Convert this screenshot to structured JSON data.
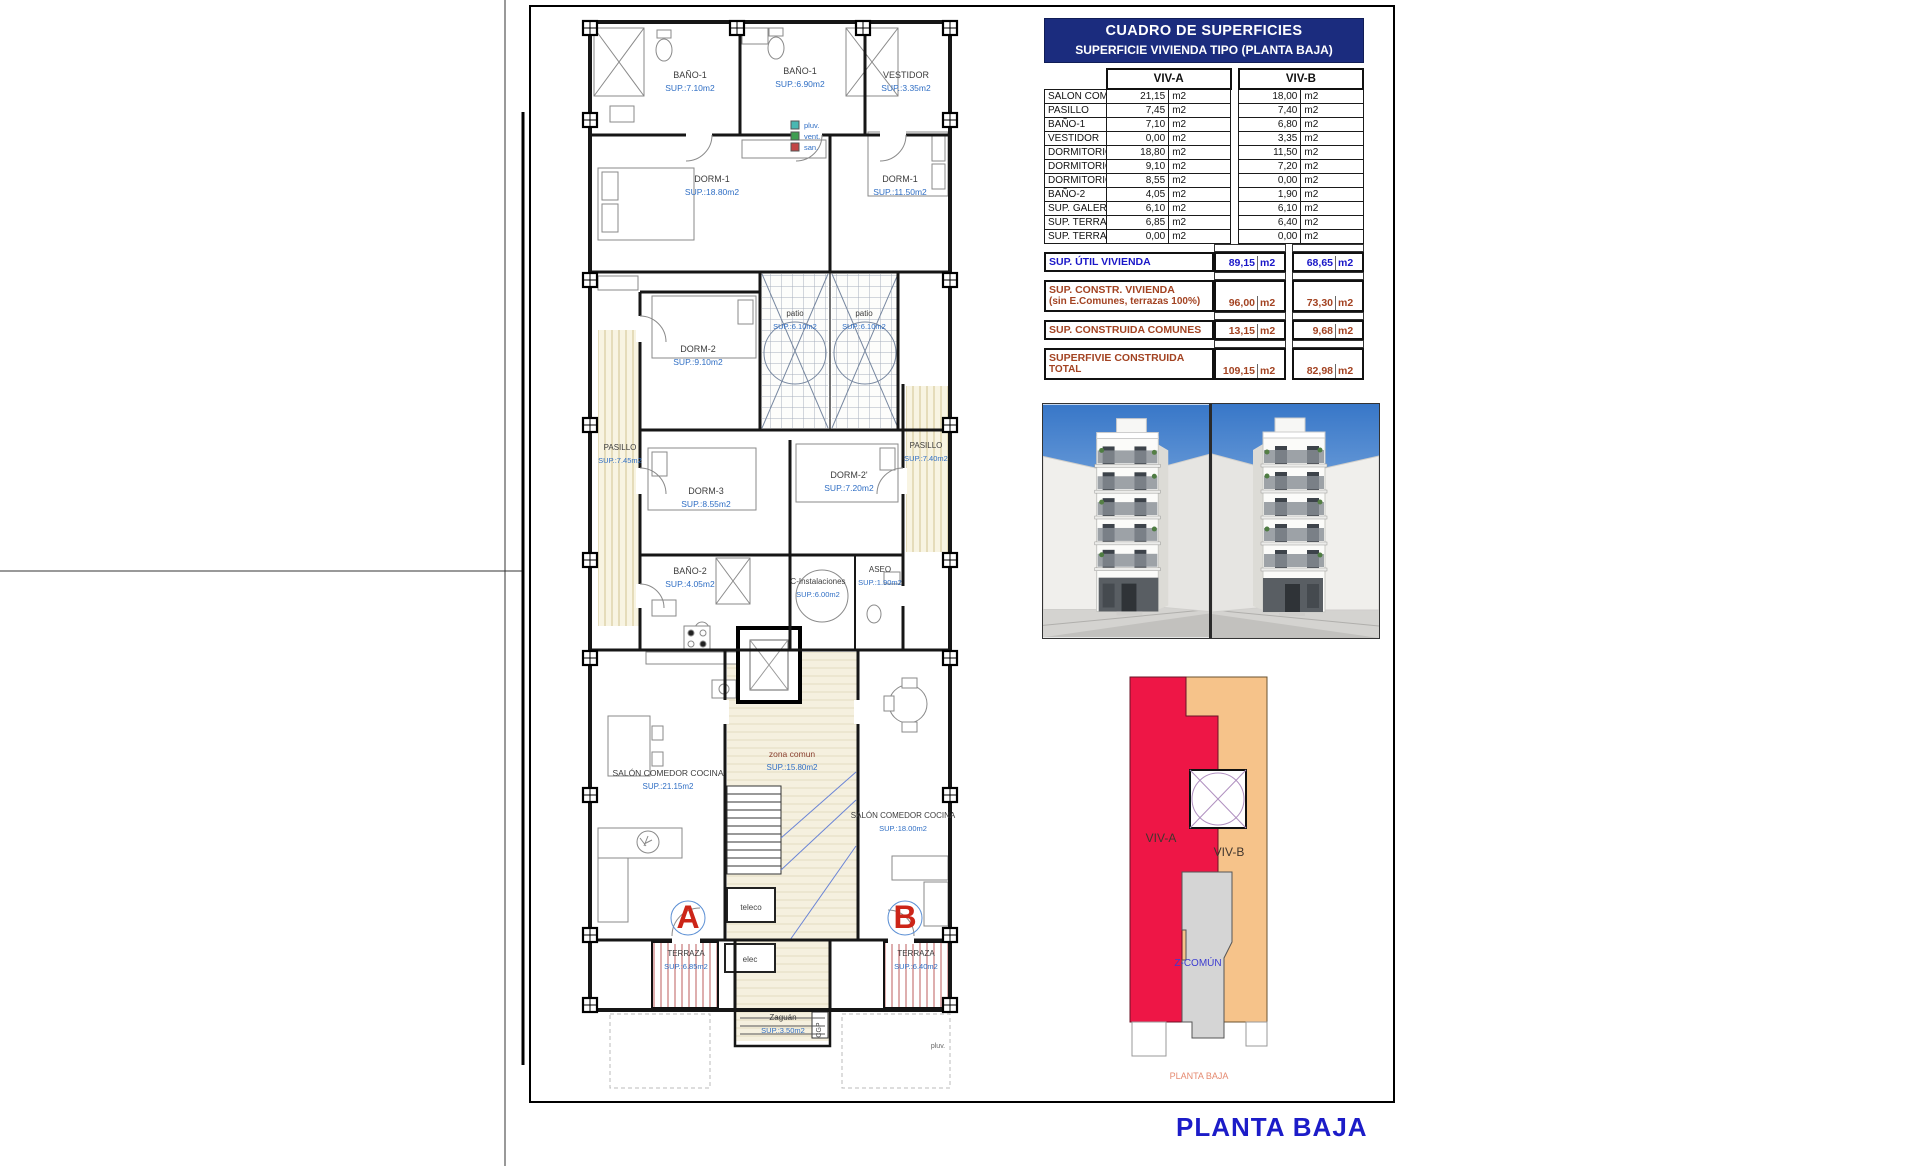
{
  "page": {
    "title": "PLANTA BAJA"
  },
  "table": {
    "title": "CUADRO DE SUPERFICIES",
    "subtitle": "SUPERFICIE VIVIENDA TIPO  (PLANTA BAJA)",
    "col_a": "VIV-A",
    "col_b": "VIV-B",
    "unit": "m2",
    "rows": [
      {
        "label": "SALON COMEDOR COCINA",
        "a": "21,15",
        "b": "18,00"
      },
      {
        "label": "PASILLO",
        "a": "7,45",
        "b": "7,40"
      },
      {
        "label": "BAÑO-1",
        "a": "7,10",
        "b": "6,80"
      },
      {
        "label": "VESTIDOR",
        "a": "0,00",
        "b": "3,35"
      },
      {
        "label": "DORMITORIO-1",
        "a": "18,80",
        "b": "11,50"
      },
      {
        "label": "DORMITORIO-2",
        "a": "9,10",
        "b": "7,20"
      },
      {
        "label": "DORMITORIO-3",
        "a": "8,55",
        "b": "0,00"
      },
      {
        "label": "BAÑO-2",
        "a": "4,05",
        "b": "1,90"
      },
      {
        "label": "SUP. GALERIA/PATIO",
        "a": "6,10",
        "b": "6,10"
      },
      {
        "label": "SUP. TERRAZA-1",
        "a": "6,85",
        "b": "6,40"
      },
      {
        "label": "SUP. TERRAZA-2",
        "a": "0,00",
        "b": "0,00"
      }
    ],
    "summary": [
      {
        "label": "SUP. ÚTIL VIVIENDA",
        "label2": "",
        "a": "89,15",
        "b": "68,65",
        "style": "blue"
      },
      {
        "label": "SUP. CONSTR. VIVIENDA",
        "label2": "(sin E.Comunes, terrazas 100%)",
        "a": "96,00",
        "b": "73,30",
        "style": "brown"
      },
      {
        "label": "SUP. CONSTRUIDA COMUNES",
        "label2": "",
        "a": "13,15",
        "b": "9,68",
        "style": "brown"
      },
      {
        "label": "SUPERFIVIE CONSTRUIDA",
        "label2": "TOTAL",
        "a": "109,15",
        "b": "82,98",
        "style": "brown"
      }
    ]
  },
  "floor_plan": {
    "rooms": [
      {
        "n": "BAÑO-1",
        "a": "SUP.:7.10m2",
        "x": 690,
        "y": 78
      },
      {
        "n": "BAÑO-1",
        "a": "SUP.:6.90m2",
        "x": 800,
        "y": 74
      },
      {
        "n": "VESTIDOR",
        "a": "SUP.:3.35m2",
        "x": 906,
        "y": 78
      },
      {
        "n": "DORM-1",
        "a": "SUP.:18.80m2",
        "x": 712,
        "y": 182
      },
      {
        "n": "DORM-1",
        "a": "SUP.:11.50m2",
        "x": 900,
        "y": 182
      },
      {
        "n": "DORM-2",
        "a": "SUP.:9.10m2",
        "x": 698,
        "y": 352
      },
      {
        "n": "patio",
        "a": "SUP.:6.10m2",
        "x": 795,
        "y": 316,
        "fs": 8
      },
      {
        "n": "patio",
        "a": "SUP.:6.10m2",
        "x": 864,
        "y": 316,
        "fs": 8
      },
      {
        "n": "PASILLO",
        "a": "SUP.:7.45m2",
        "x": 620,
        "y": 450,
        "fs": 8
      },
      {
        "n": "DORM-3",
        "a": "SUP.:8.55m2",
        "x": 706,
        "y": 494
      },
      {
        "n": "DORM-2'",
        "a": "SUP.:7.20m2",
        "x": 849,
        "y": 478
      },
      {
        "n": "PASILLO",
        "a": "SUP.:7.40m2",
        "x": 926,
        "y": 448,
        "fs": 8
      },
      {
        "n": "BAÑO-2",
        "a": "SUP.:4.05m2",
        "x": 690,
        "y": 574
      },
      {
        "n": "C-Instalaciones",
        "a": "SUP.:6.00m2",
        "x": 818,
        "y": 584,
        "fs": 8
      },
      {
        "n": "ASEO",
        "a": "SUP.:1.90m2",
        "x": 880,
        "y": 572,
        "fs": 8
      },
      {
        "n": "SALÓN COMEDOR COCINA",
        "a": "SUP.:21.15m2",
        "x": 668,
        "y": 776,
        "fs": 8.5
      },
      {
        "n": "zona comun",
        "a": "SUP.:15.80m2",
        "x": 792,
        "y": 757,
        "fs": 8.5,
        "nc": "#8a4030"
      },
      {
        "n": "SALÓN COMEDOR COCINA",
        "a": "SUP.:18.00m2",
        "x": 903,
        "y": 818,
        "fs": 8
      },
      {
        "n": "TERRAZA",
        "a": "SUP.:6.85m2",
        "x": 686,
        "y": 956,
        "fs": 8
      },
      {
        "n": "TERRAZA",
        "a": "SUP.:6.40m2",
        "x": 916,
        "y": 956,
        "fs": 8
      },
      {
        "n": "Zaguán",
        "a": "SUP.:3.50m2",
        "x": 783,
        "y": 1020,
        "fs": 8
      }
    ],
    "marks": [
      {
        "t": "A",
        "x": 688,
        "y": 928,
        "c": "#cc2518",
        "s": 32,
        "b": true
      },
      {
        "t": "B",
        "x": 905,
        "y": 928,
        "c": "#cc2518",
        "s": 32,
        "b": true
      },
      {
        "t": "teleco",
        "x": 751,
        "y": 910,
        "c": "#444444",
        "s": 8
      },
      {
        "t": "elec",
        "x": 750,
        "y": 962,
        "c": "#444444",
        "s": 8
      },
      {
        "t": "CGP",
        "x": 821,
        "y": 1030,
        "c": "#444444",
        "s": 7,
        "rot": -90
      },
      {
        "t": "pluv.",
        "x": 938,
        "y": 1048,
        "c": "#666666",
        "s": 7
      }
    ],
    "legend": {
      "x": 791,
      "y": 128,
      "items": [
        {
          "label": "pluv.",
          "color": "#49b8b2"
        },
        {
          "label": "vent.",
          "color": "#3f9e52"
        },
        {
          "label": "san.",
          "color": "#c24545"
        }
      ]
    }
  },
  "diagram": {
    "colors": {
      "viv_a": "#ee1646",
      "viv_b": "#f6c38a",
      "comun": "#d5d5d5"
    },
    "labels": [
      {
        "t": "VIV-A",
        "x": 1161,
        "y": 842,
        "c": "#40362e",
        "s": 12
      },
      {
        "t": "VIV-B",
        "x": 1229,
        "y": 856,
        "c": "#40362e",
        "s": 12
      },
      {
        "t": "Z-COMÚN",
        "x": 1198,
        "y": 966,
        "c": "#3c3cd0",
        "s": 10
      },
      {
        "t": "PLANTA BAJA",
        "x": 1199,
        "y": 1079,
        "c": "#e58a70",
        "s": 9
      }
    ]
  }
}
